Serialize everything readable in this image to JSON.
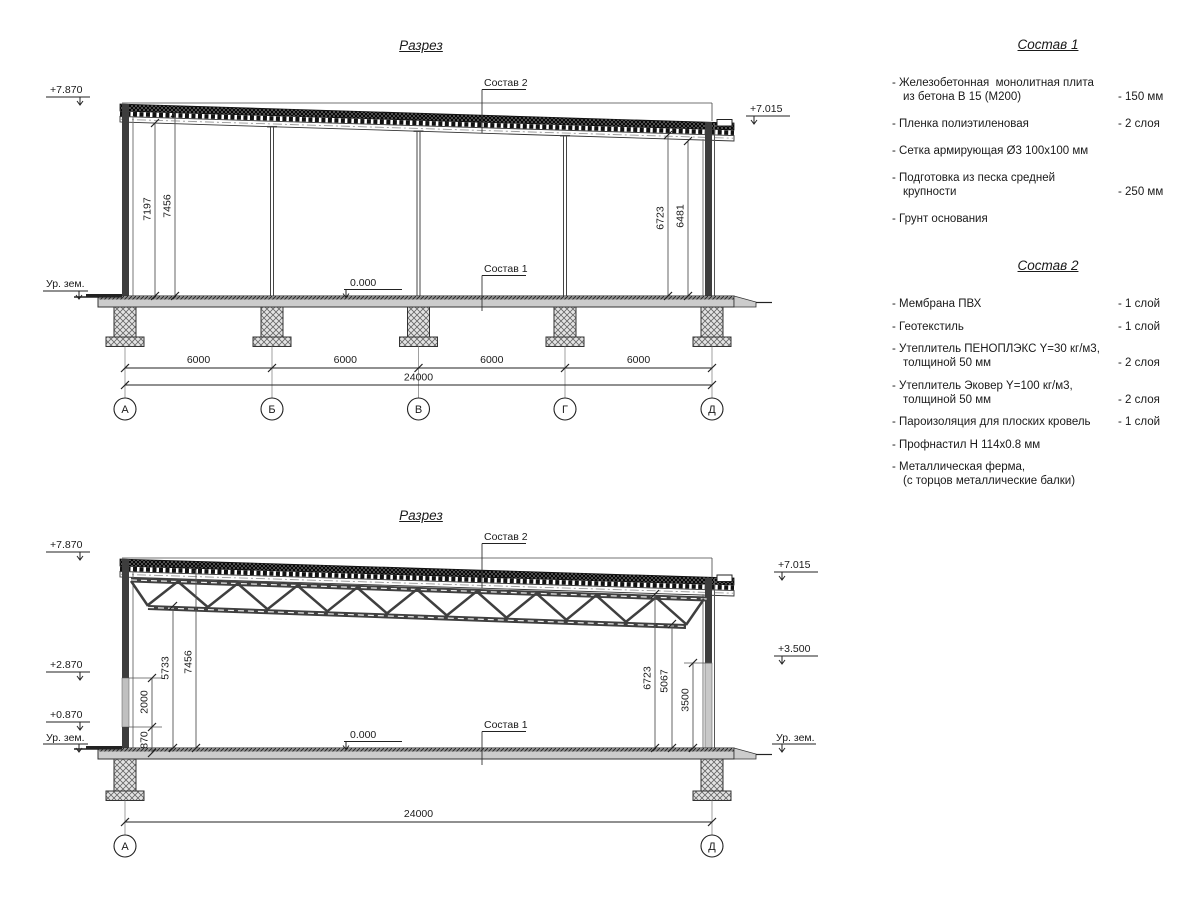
{
  "titles": {
    "section1": "Разрез",
    "section2": "Разрез"
  },
  "drawing1": {
    "labels": {
      "sostav2_ref": "Состав 2",
      "sostav1_ref": "Состав 1",
      "zero_level": "0.000",
      "ground_left": "Ур. зем."
    },
    "elevations": {
      "left_top": "+7.870",
      "right_top": "+7.015"
    },
    "vdims": {
      "left_inner": "7197",
      "left_outer": "7456",
      "right_inner": "6723",
      "right_outer": "6481"
    },
    "hdims": {
      "spans": [
        "6000",
        "6000",
        "6000",
        "6000"
      ],
      "total": "24000"
    },
    "grid": [
      "А",
      "Б",
      "В",
      "Г",
      "Д"
    ]
  },
  "drawing2": {
    "labels": {
      "sostav2_ref": "Состав 2",
      "sostav1_ref": "Состав 1",
      "zero_level": "0.000",
      "ground_left": "Ур. зем.",
      "ground_right": "Ур. зем."
    },
    "elevations": {
      "left_top": "+7.870",
      "left_mid": "+2.870",
      "left_low": "+0.870",
      "right_top": "+7.015",
      "right_mid": "+3.500"
    },
    "vdims": {
      "d2000": "2000",
      "d870": "870",
      "left_inner": "5733",
      "left_outer": "7456",
      "right_outer": "6723",
      "right_mid": "5067",
      "right_low": "3500"
    },
    "hdims": {
      "total": "24000"
    },
    "grid": [
      "А",
      "Д"
    ]
  },
  "sostav1": {
    "title": "Состав 1",
    "items": [
      {
        "text": "- Железобетонная  монолитная плита\nиз бетона В 15 (М200)",
        "value": "- 150 мм"
      },
      {
        "text": "- Пленка полиэтиленовая",
        "value": "-  2 слоя"
      },
      {
        "text": "- Сетка армирующая Ø3 100х100 мм",
        "value": ""
      },
      {
        "text": "- Подготовка из песка средней\nкрупности",
        "value": "- 250 мм"
      },
      {
        "text": "- Грунт основания",
        "value": ""
      }
    ]
  },
  "sostav2": {
    "title": "Состав 2",
    "items": [
      {
        "text": "- Мембрана ПВХ",
        "value": "- 1 слой"
      },
      {
        "text": "- Геотекстиль",
        "value": "- 1 слой"
      },
      {
        "text": "- Утеплитель ПЕНОПЛЭКС Y=30 кг/м3,\nтолщиной 50 мм",
        "value": "- 2 слоя"
      },
      {
        "text": "- Утеплитель Эковер Y=100 кг/м3,\nтолщиной 50 мм",
        "value": "- 2 слоя"
      },
      {
        "text": "- Пароизоляция для плоских кровель",
        "value": "- 1 слой"
      },
      {
        "text": "- Профнастил Н 114х0.8 мм",
        "value": ""
      },
      {
        "text": "- Металлическая ферма,\n(с торцов металлические балки)",
        "value": ""
      }
    ]
  }
}
